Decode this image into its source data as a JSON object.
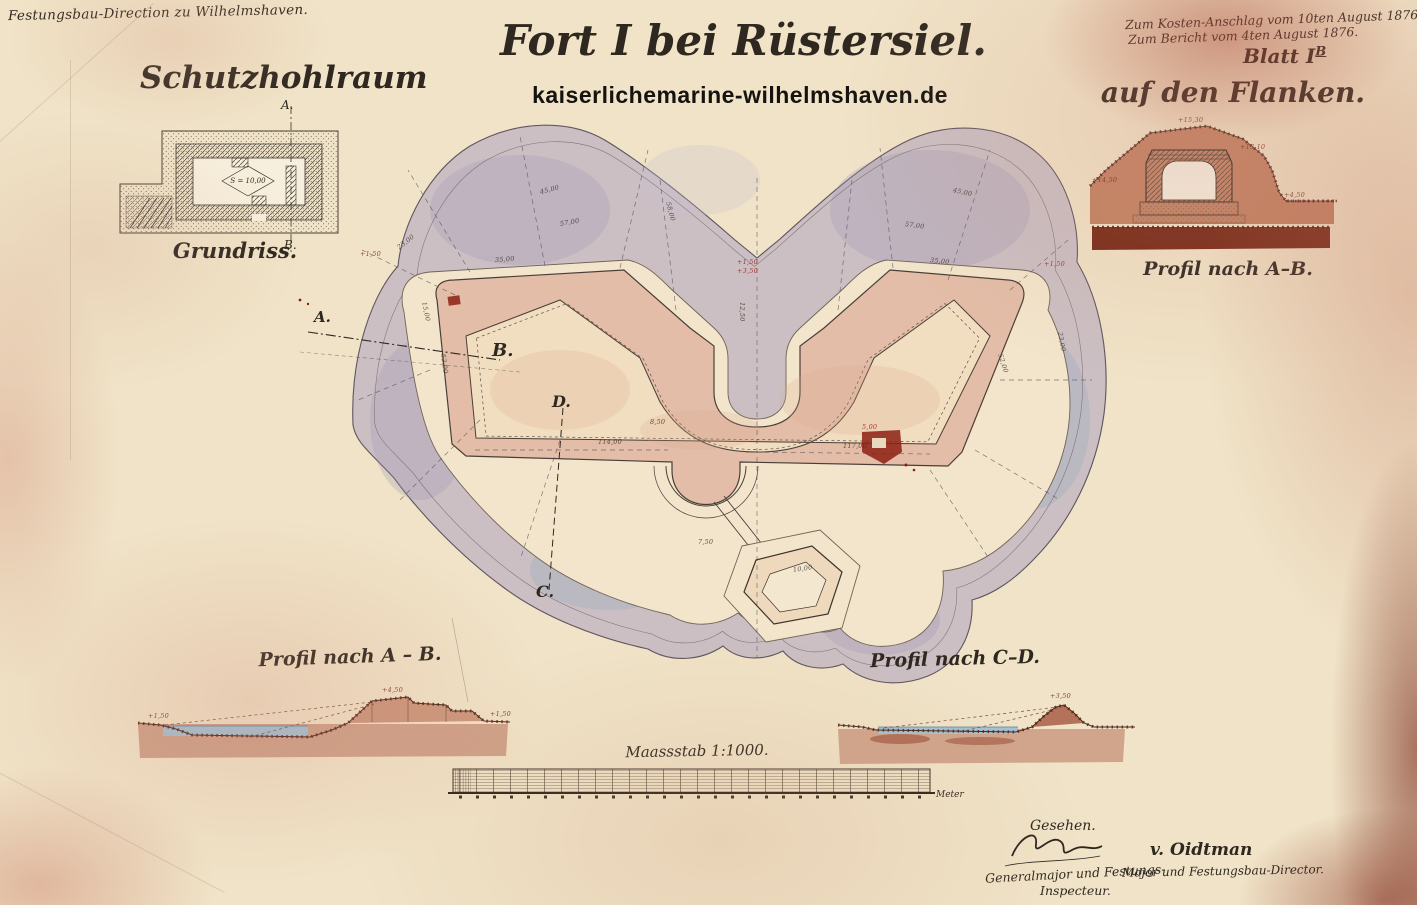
{
  "header": {
    "office_line": "Festungsbau-Direction zu Wilhelmshaven.",
    "title": "Fort I bei Rüstersiel.",
    "watermark": "kaiserlichemarine-wilhelmshaven.de",
    "approval_line1": "Zum Kosten-Anschlag vom 10ten August 1876.",
    "approval_line2": "Zum Bericht vom 4ten August 1876.",
    "sheet_label": "Blatt I",
    "sheet_suffix": "B"
  },
  "detail_plan": {
    "title": "Schutzhohlraum",
    "caption": "Grundriss.",
    "marker_top": "A.",
    "marker_bottom": "B.",
    "room_area": "S = 10,00"
  },
  "flank_profile": {
    "title": "auf den Flanken.",
    "caption": "Profil nach A–B."
  },
  "plan": {
    "marker_a": "A.",
    "marker_b": "B.",
    "marker_c": "C.",
    "marker_d": "D.",
    "annotations": [
      {
        "x": 737,
        "y": 258,
        "t": "+1,50",
        "c": "#9c2318"
      },
      {
        "x": 737,
        "y": 267,
        "t": "+3,50",
        "c": "#9c2318"
      },
      {
        "x": 360,
        "y": 250,
        "t": "+1,50",
        "c": "#9c2318"
      },
      {
        "x": 1044,
        "y": 260,
        "t": "+1,50",
        "c": "#9c2318"
      },
      {
        "x": 862,
        "y": 423,
        "t": "5,00",
        "c": "#9c2318"
      },
      {
        "x": 495,
        "y": 256,
        "t": "35,00",
        "r": -4
      },
      {
        "x": 560,
        "y": 220,
        "t": "57,00",
        "r": -10
      },
      {
        "x": 905,
        "y": 220,
        "t": "57,00",
        "r": 8
      },
      {
        "x": 598,
        "y": 438,
        "t": "114,00"
      },
      {
        "x": 843,
        "y": 442,
        "t": "117,00"
      },
      {
        "x": 443,
        "y": 350,
        "t": "52,00",
        "r": 82
      },
      {
        "x": 1000,
        "y": 350,
        "t": "52,00",
        "r": 72
      },
      {
        "x": 930,
        "y": 256,
        "t": "35,00",
        "r": 6
      },
      {
        "x": 398,
        "y": 244,
        "t": "23,00",
        "r": -38
      },
      {
        "x": 1060,
        "y": 328,
        "t": "23,00",
        "r": 80
      },
      {
        "x": 742,
        "y": 298,
        "t": "12,50",
        "r": 90
      },
      {
        "x": 698,
        "y": 538,
        "t": "7,50"
      },
      {
        "x": 793,
        "y": 566,
        "t": "10,00",
        "r": -8
      },
      {
        "x": 650,
        "y": 418,
        "t": "8,50"
      },
      {
        "x": 424,
        "y": 298,
        "t": "15,00",
        "r": 78
      },
      {
        "x": 540,
        "y": 188,
        "t": "45,00",
        "r": -14
      },
      {
        "x": 953,
        "y": 186,
        "t": "45,00",
        "r": 12
      },
      {
        "x": 668,
        "y": 198,
        "t": "58,00",
        "r": 75
      },
      {
        "x": 382,
        "y": 686,
        "t": "+4,50",
        "c": "#6e2a1a"
      },
      {
        "x": 148,
        "y": 712,
        "t": "+1,50",
        "c": "#6e2a1a"
      },
      {
        "x": 490,
        "y": 710,
        "t": "+1,50",
        "c": "#6e2a1a"
      },
      {
        "x": 1050,
        "y": 692,
        "t": "+3,50",
        "c": "#6e2a1a"
      },
      {
        "x": 1178,
        "y": 116,
        "t": "+15,30",
        "c": "#6e2a1a"
      },
      {
        "x": 1240,
        "y": 143,
        "t": "+13,10",
        "c": "#6e2a1a"
      },
      {
        "x": 1284,
        "y": 191,
        "t": "+4,50",
        "c": "#6e2a1a"
      },
      {
        "x": 1092,
        "y": 176,
        "t": "+14,50",
        "c": "#6e2a1a"
      }
    ]
  },
  "profiles": {
    "left_caption": "Profil nach A – B.",
    "right_caption": "Profil nach C–D."
  },
  "scale_bar": {
    "caption": "Maassstab 1:1000.",
    "unit_label": "Meter"
  },
  "signatures": {
    "seen": "Gesehen.",
    "left_role_line1": "Generalmajor und Festungs-",
    "left_role_line2": "Inspecteur.",
    "right_name": "v. Oidtman",
    "right_role": "Major und Festungsbau-Director."
  },
  "colors": {
    "paper": "#f0e3c7",
    "glacis_wash": "#b2a6bf",
    "rampart_wash": "#e3bda7",
    "ditch": "#f2e5cb",
    "earth_wash": "#c08a72",
    "earth_dark": "#77281a",
    "water": "#a3c2d2",
    "red_ink": "#9c2318"
  }
}
